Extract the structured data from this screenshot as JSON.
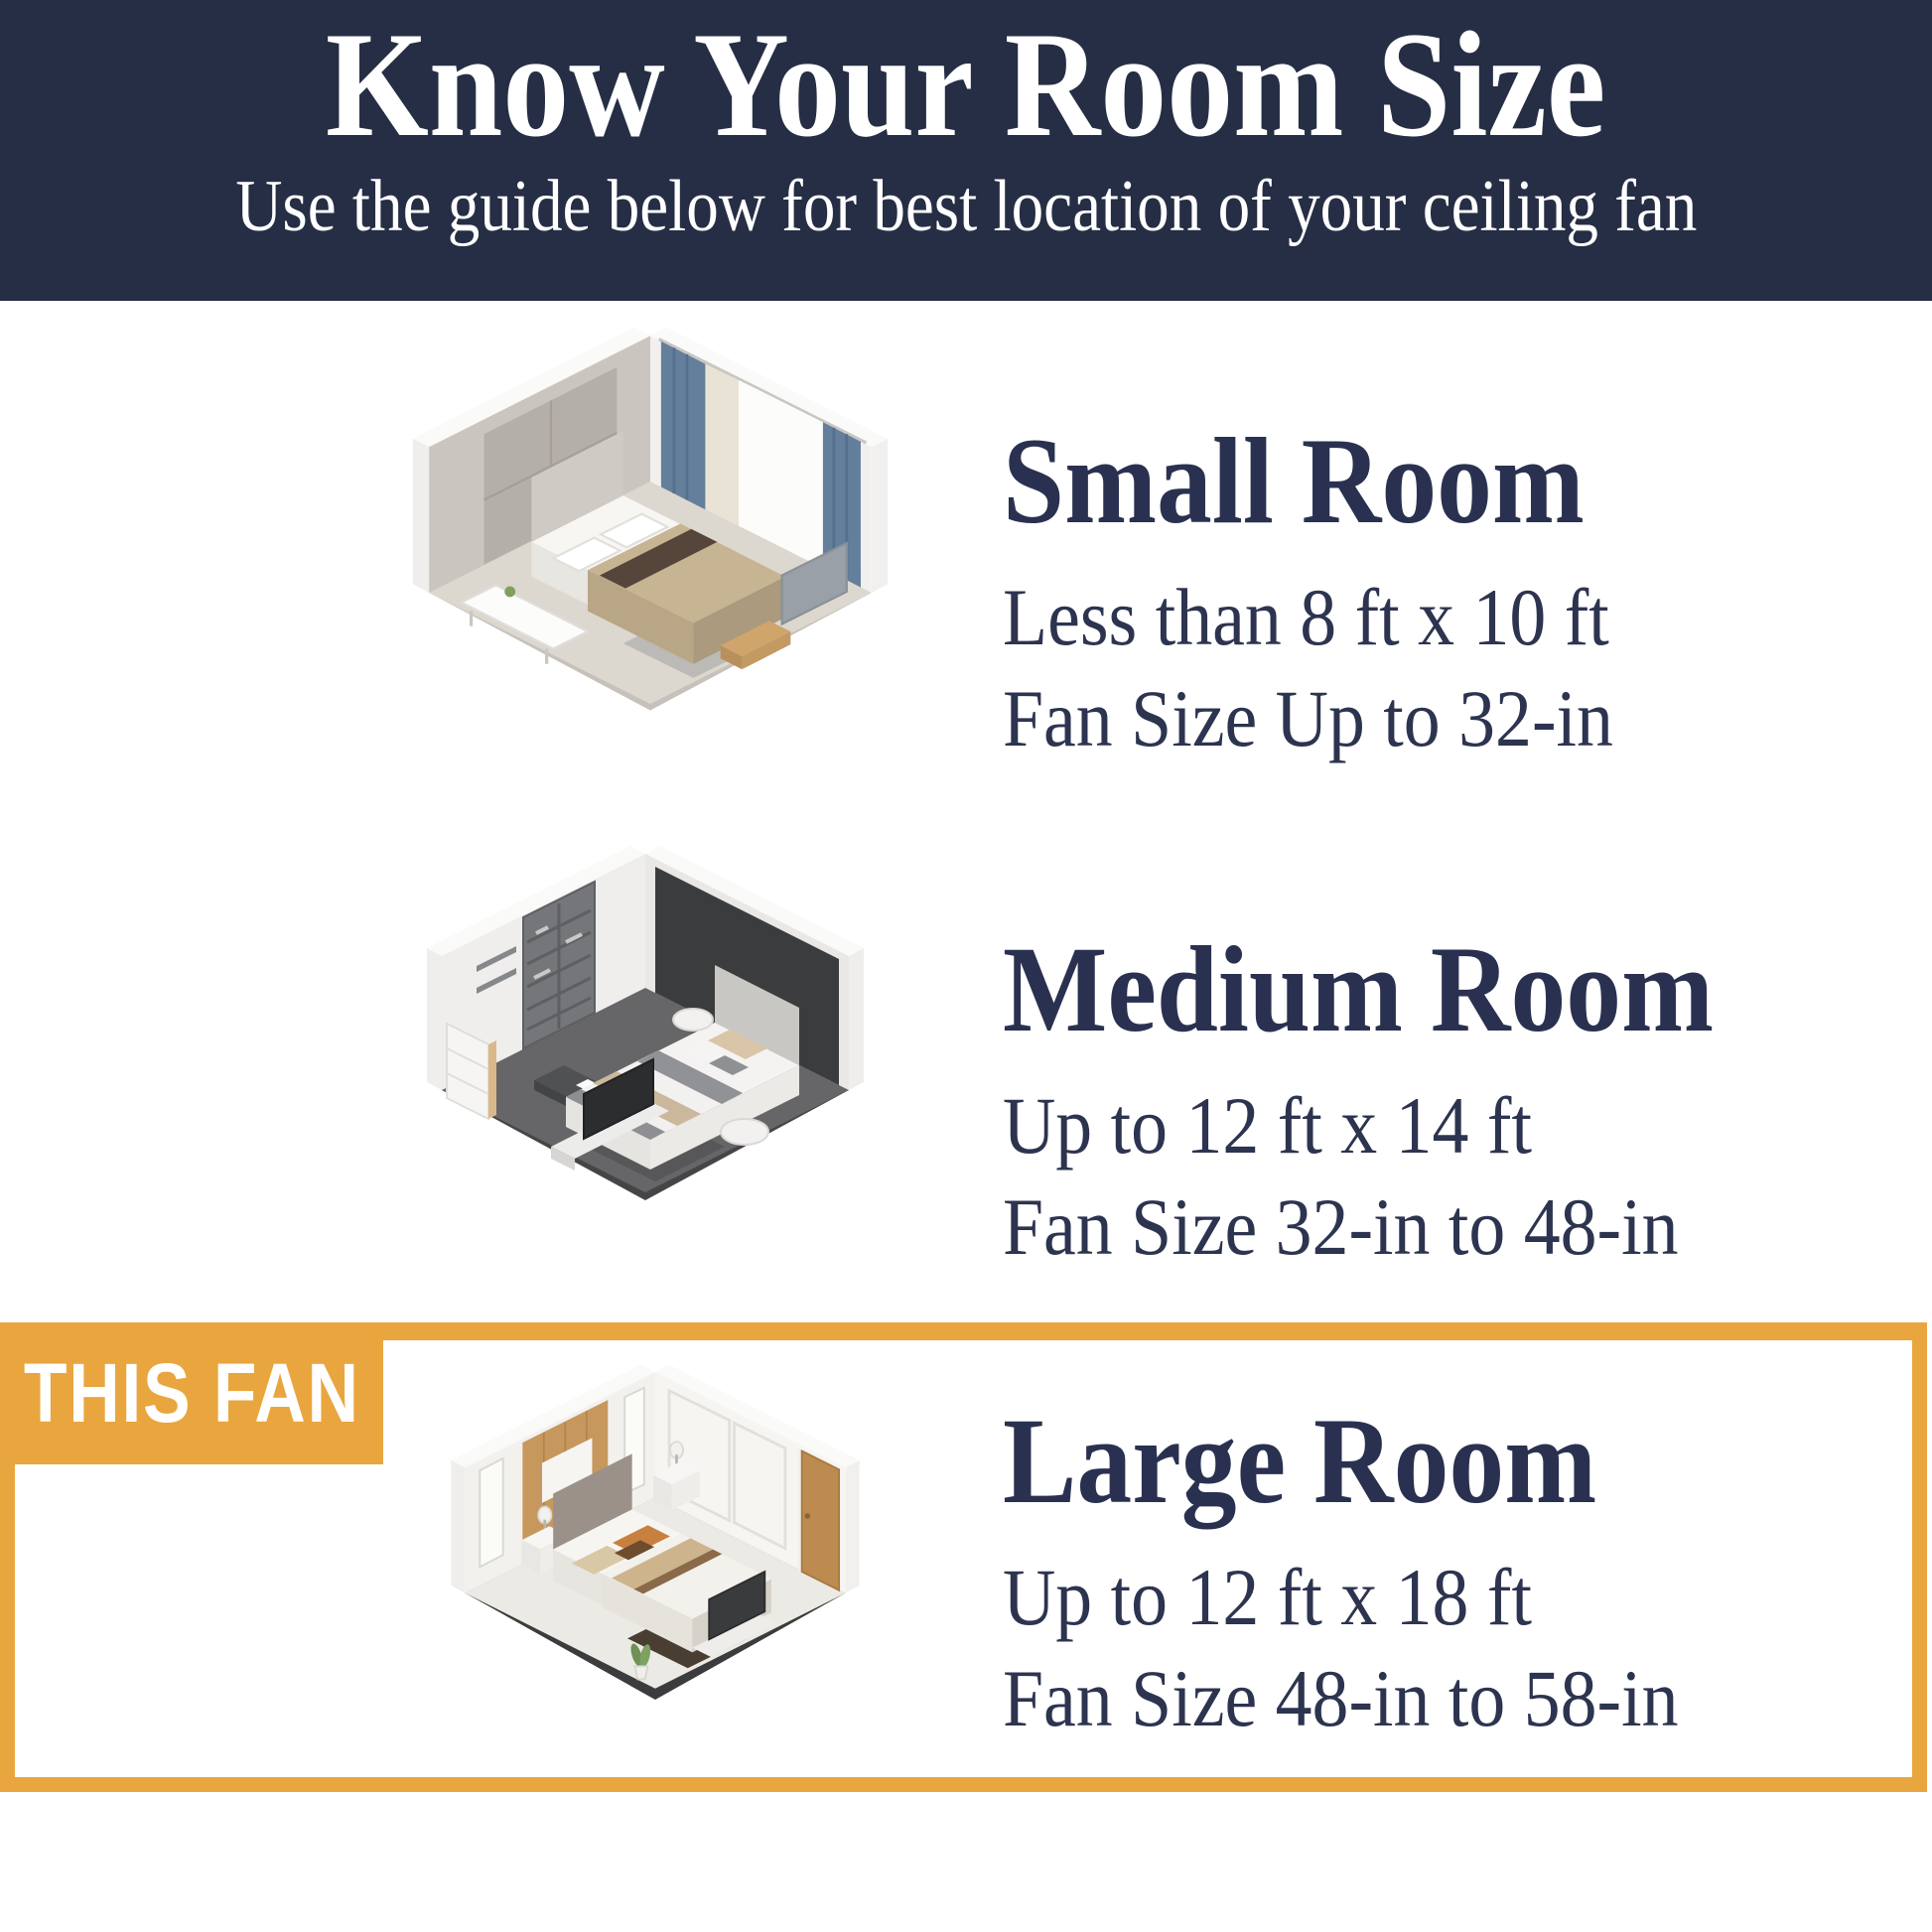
{
  "header": {
    "title": "Know Your Room Size",
    "subtitle": "Use the guide below for best location of your ceiling fan"
  },
  "colors": {
    "header_background": "#262e45",
    "heading_text": "#2a3150",
    "body_text": "#2d3450",
    "highlight_orange": "#e9a63f",
    "badge_text": "#ffffff",
    "page_background": "#ffffff"
  },
  "sections": [
    {
      "heading": "Small Room",
      "size_range": "Less than 8 ft x 10 ft",
      "fan_size": "Fan Size Up to 32-in",
      "illustration": "small-bedroom-isometric",
      "highlighted": false
    },
    {
      "heading": "Medium Room",
      "size_range": "Up to 12 ft x 14 ft",
      "fan_size": "Fan Size 32-in to 48-in",
      "illustration": "medium-bedroom-isometric",
      "highlighted": false
    },
    {
      "heading": "Large Room",
      "size_range": "Up to 12 ft x 18 ft",
      "fan_size": "Fan Size 48-in to 58-in",
      "illustration": "large-bedroom-isometric",
      "highlighted": true,
      "badge": "THIS FAN"
    }
  ]
}
